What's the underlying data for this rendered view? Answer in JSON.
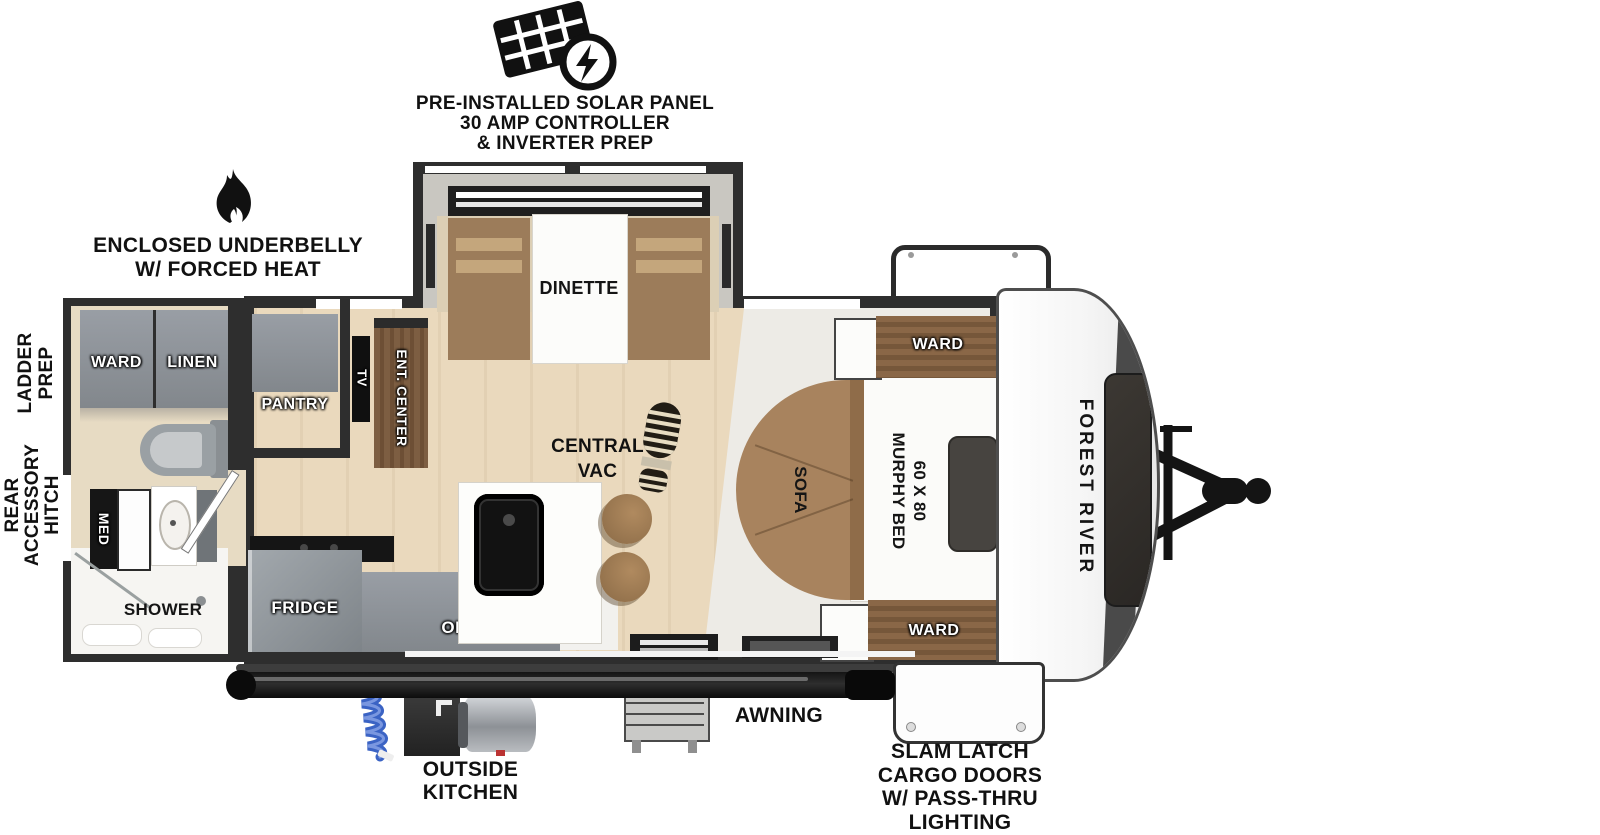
{
  "title": "Forest River travel trailer floorplan",
  "colors": {
    "wall": "#2e2e2e",
    "cabinet_gray": "#8b9094",
    "wood_brown": "#7d5e42",
    "floor_tan": "#ead9bd",
    "bench_tan": "#9c7c5a",
    "sofa_brown": "#a8835e",
    "hose_blue": "#3b63c4",
    "black": "#111111",
    "white": "#ffffff"
  },
  "annotations": {
    "solar": {
      "lines": [
        "PRE-INSTALLED SOLAR PANEL",
        "30 AMP CONTROLLER",
        "& INVERTER PREP"
      ]
    },
    "underbelly": {
      "lines": [
        "ENCLOSED UNDERBELLY",
        "W/ FORCED HEAT"
      ]
    },
    "ladder_prep": {
      "lines": [
        "LADDER",
        "PREP"
      ]
    },
    "rear_hitch": {
      "lines": [
        "REAR",
        "ACCESSORY",
        "HITCH"
      ]
    },
    "awning": "AWNING",
    "outside_kitchen": {
      "lines": [
        "OUTSIDE",
        "KITCHEN"
      ]
    },
    "slam_latch": {
      "lines": [
        "SLAM LATCH",
        "CARGO DOORS",
        "W/ PASS-THRU",
        "LIGHTING"
      ]
    }
  },
  "labels": {
    "ward_bath": "WARD",
    "linen": "LINEN",
    "pantry": "PANTRY",
    "med": "MED",
    "shower": "SHOWER",
    "fridge": "FRIDGE",
    "ohc": "OHC",
    "tv": "TV",
    "ent_center": "ENT. CENTER",
    "dinette": "DINETTE",
    "central_vac": {
      "lines": [
        "CENTRAL",
        "VAC"
      ]
    },
    "sofa": "SOFA",
    "murphy_bed": {
      "lines": [
        "60 X 80",
        "MURPHY BED"
      ]
    },
    "ward_bed_top": "WARD",
    "ward_bed_bottom": "WARD",
    "brand": "FOREST RIVER"
  }
}
